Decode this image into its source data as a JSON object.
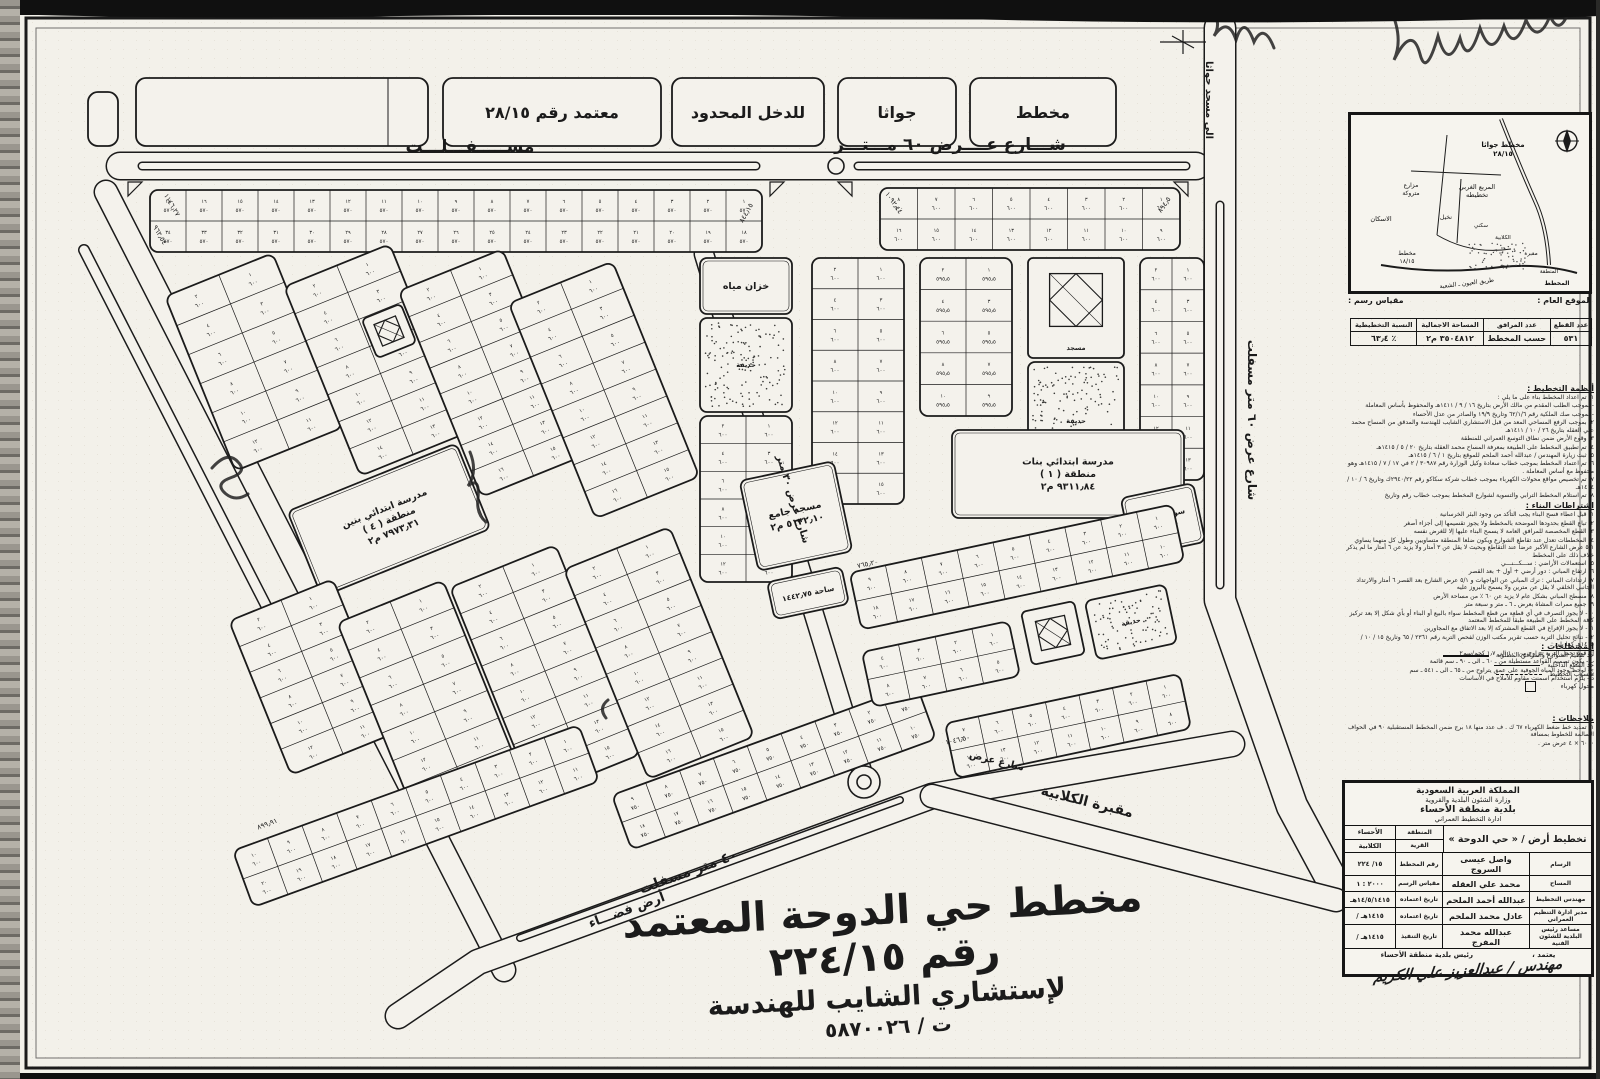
{
  "document": {
    "type": "مخطط تقسيم أراضٍ معتمد",
    "plan_number": "٢٢٤/١٥"
  },
  "calligraphy": {
    "line1": "مخطط حي الدوحة المعتمد رقم ٢٢٤/١٥",
    "line2": "لإستشاري الشايب للهندسة",
    "line3": "ت / ٥٨٧٠٠٢٦"
  },
  "map": {
    "paper": "#f4f2ec",
    "ink": "#1b1b1b",
    "roads": [
      {
        "d": "M 120 166 H 1196",
        "w": 26
      },
      {
        "d": "M 1220 28 L 1220 600 L 1292 806 L 1334 884",
        "w": 30
      },
      {
        "d": "M 106 192 L 504 970",
        "w": 22
      },
      {
        "d": "M 398 1016 L 478 962 L 932 796 L 1232 744",
        "w": 24
      },
      {
        "d": "M 704 254 L 864 778",
        "w": 18
      },
      {
        "d": "M 932 796 L 1336 900",
        "w": 22
      },
      {
        "d": "M 84 250 L 300 672",
        "w": 9
      }
    ],
    "medians": [
      {
        "d": "M 142 166 H 756",
        "w": 6
      },
      {
        "d": "M 858 166 H 1186",
        "w": 6
      },
      {
        "d": "M 1220 205 V 585",
        "w": 6
      },
      {
        "d": "M 520 938 L 900 800",
        "w": 5
      }
    ],
    "circles": [
      {
        "x": 836,
        "y": 166,
        "r": 8
      },
      {
        "x": 864,
        "y": 782,
        "r": 16
      },
      {
        "x": 864,
        "y": 782,
        "r": 7
      }
    ],
    "blocks": [
      {
        "type": "labelbox",
        "x": 88,
        "y": 92,
        "w": 30,
        "h": 54
      },
      {
        "type": "labelbox",
        "x": 136,
        "y": 78,
        "w": 292,
        "h": 68,
        "divider": 388
      },
      {
        "type": "labelbox",
        "x": 443,
        "y": 78,
        "w": 218,
        "h": 68,
        "label": "معتمد رقم ٢٨/١٥"
      },
      {
        "type": "labelbox",
        "x": 672,
        "y": 78,
        "w": 152,
        "h": 68,
        "label": "للدخل المحدود"
      },
      {
        "type": "labelbox",
        "x": 838,
        "y": 78,
        "w": 118,
        "h": 68,
        "label": "جواثا"
      },
      {
        "type": "labelbox",
        "x": 970,
        "y": 78,
        "w": 146,
        "h": 68,
        "label": "مخطط"
      },
      {
        "type": "parcels",
        "x": 150,
        "y": 190,
        "w": 612,
        "h": 62,
        "cols": 17,
        "rows": 2,
        "rot": 0,
        "area": "٥٧٠"
      },
      {
        "type": "parcels",
        "x": 880,
        "y": 188,
        "w": 300,
        "h": 62,
        "cols": 8,
        "rows": 2,
        "rot": 0,
        "area": "٦٠٠"
      },
      {
        "type": "parcels",
        "x": 196,
        "y": 268,
        "w": 116,
        "h": 188,
        "cols": 2,
        "rows": 6,
        "rot": -22,
        "area": "٦٠٠"
      },
      {
        "type": "parcels",
        "x": 318,
        "y": 258,
        "w": 114,
        "h": 204,
        "cols": 2,
        "rows": 7,
        "rot": -22,
        "area": "٦٠٠"
      },
      {
        "type": "parcels",
        "x": 436,
        "y": 262,
        "w": 112,
        "h": 222,
        "cols": 2,
        "rows": 8,
        "rot": -22,
        "area": "٦٠٠"
      },
      {
        "type": "parcels",
        "x": 548,
        "y": 274,
        "w": 112,
        "h": 232,
        "cols": 2,
        "rows": 8,
        "rot": -22,
        "area": "٦٠٠"
      },
      {
        "type": "mosque",
        "x": 368,
        "y": 310,
        "w": 42,
        "h": 42,
        "rot": -22,
        "small": true
      },
      {
        "type": "facility",
        "x": 298,
        "y": 474,
        "w": 182,
        "h": 92,
        "rot": -22,
        "lines": [
          "مدرسة ابتدائي بنين",
          "منطقة ( ٤ )",
          "٧٩٧٣٫٣١ م٢"
        ]
      },
      {
        "type": "parcels",
        "x": 256,
        "y": 594,
        "w": 112,
        "h": 166,
        "cols": 2,
        "rows": 6,
        "rot": -22,
        "area": "٦٠٠"
      },
      {
        "type": "parcels",
        "x": 372,
        "y": 594,
        "w": 114,
        "h": 208,
        "cols": 2,
        "rows": 7,
        "rot": -22,
        "area": "٦٠٠"
      },
      {
        "type": "parcels",
        "x": 488,
        "y": 558,
        "w": 114,
        "h": 226,
        "cols": 2,
        "rows": 8,
        "rot": -22,
        "area": "٦٠٠"
      },
      {
        "type": "parcels",
        "x": 602,
        "y": 540,
        "w": 114,
        "h": 226,
        "cols": 2,
        "rows": 8,
        "rot": -22,
        "area": "٦٠٠"
      },
      {
        "type": "parcels",
        "x": 232,
        "y": 786,
        "w": 368,
        "h": 60,
        "cols": 10,
        "rows": 2,
        "rot": -20,
        "area": "٦٠٠"
      },
      {
        "type": "parcels",
        "x": 612,
        "y": 738,
        "w": 324,
        "h": 58,
        "cols": 9,
        "rows": 2,
        "rot": -20,
        "area": "٧٥٠"
      },
      {
        "type": "facility",
        "x": 700,
        "y": 258,
        "w": 92,
        "h": 56,
        "rot": 0,
        "lines": [
          "خزان مياه"
        ]
      },
      {
        "type": "park",
        "x": 700,
        "y": 318,
        "w": 92,
        "h": 94,
        "label": "حديقة"
      },
      {
        "type": "parcels",
        "x": 700,
        "y": 416,
        "w": 92,
        "h": 166,
        "cols": 2,
        "rows": 6,
        "rot": 0,
        "area": "٦٠٠"
      },
      {
        "type": "parcels",
        "x": 812,
        "y": 258,
        "w": 92,
        "h": 246,
        "cols": 2,
        "rows": 8,
        "rot": 0,
        "area": "٦٠٠"
      },
      {
        "type": "parcels",
        "x": 920,
        "y": 258,
        "w": 92,
        "h": 158,
        "cols": 2,
        "rows": 5,
        "rot": 0,
        "area": "٥٩٥٫٥"
      },
      {
        "type": "mosque",
        "x": 1028,
        "y": 258,
        "w": 96,
        "h": 100,
        "rot": 0,
        "label": "مسجد"
      },
      {
        "type": "park",
        "x": 1028,
        "y": 362,
        "w": 96,
        "h": 118,
        "label": "حديقة"
      },
      {
        "type": "parcels",
        "x": 1140,
        "y": 258,
        "w": 64,
        "h": 222,
        "cols": 2,
        "rows": 7,
        "rot": 0,
        "area": "٦٠٠"
      },
      {
        "type": "facility",
        "x": 952,
        "y": 430,
        "w": 232,
        "h": 88,
        "rot": 0,
        "lines": [
          "مدرسة ابتدائي بنات",
          "منطقة ( ١ )",
          "٩٣١١٫٨٤ م٢"
        ]
      },
      {
        "type": "facility",
        "x": 748,
        "y": 470,
        "w": 96,
        "h": 92,
        "rot": -12,
        "lines": [
          "مسجد جامع",
          "٥١٣٢٫١٠ م٢"
        ]
      },
      {
        "type": "facility",
        "x": 770,
        "y": 574,
        "w": 76,
        "h": 38,
        "rot": -12,
        "lines": [
          "ساحة ١٤٤٢٫٧٥"
        ]
      },
      {
        "type": "facility",
        "x": 1126,
        "y": 490,
        "w": 74,
        "h": 60,
        "rot": -12,
        "lines": [
          "سوق مركزي",
          "٥١٦٢٫٥٠"
        ]
      },
      {
        "type": "parcels",
        "x": 852,
        "y": 538,
        "w": 330,
        "h": 58,
        "cols": 9,
        "rows": 2,
        "rot": -12,
        "area": "٦٠٠"
      },
      {
        "type": "parcels",
        "x": 866,
        "y": 636,
        "w": 150,
        "h": 56,
        "cols": 4,
        "rows": 2,
        "rot": -12,
        "area": "٦٠٠"
      },
      {
        "type": "mosque",
        "x": 1026,
        "y": 606,
        "w": 54,
        "h": 54,
        "rot": -12,
        "small": true
      },
      {
        "type": "park",
        "x": 1090,
        "y": 592,
        "w": 82,
        "h": 60,
        "rot": -12,
        "label": "حديقة"
      },
      {
        "type": "parcels",
        "x": 948,
        "y": 698,
        "w": 240,
        "h": 56,
        "cols": 7,
        "rows": 2,
        "rot": -12,
        "area": "٦٠٠"
      }
    ],
    "street_labels": [
      {
        "t": "مســـــفـــلـــت",
        "x": 470,
        "y": 152,
        "s": 17,
        "r": 0
      },
      {
        "t": "شـــارع عــــرض  ٦٠  مـــتـــر",
        "x": 950,
        "y": 150,
        "s": 17,
        "r": 0
      },
      {
        "t": "شارع عرض ٦٠ متر مسفلت",
        "x": 1248,
        "y": 420,
        "s": 12,
        "r": 90
      },
      {
        "t": "الى مسجد جواثا",
        "x": 1206,
        "y": 100,
        "s": 10,
        "r": 90
      },
      {
        "t": "شارع عرض ٣٠ متر",
        "x": 790,
        "y": 500,
        "s": 10,
        "r": 73
      },
      {
        "t": "٤٠ متر مسفلت",
        "x": 690,
        "y": 876,
        "s": 14,
        "r": -20
      },
      {
        "t": "أرض فضـــاء",
        "x": 628,
        "y": 914,
        "s": 13,
        "r": -20
      },
      {
        "t": "مقبرة الكلابية",
        "x": 1086,
        "y": 806,
        "s": 14,
        "r": 14
      },
      {
        "t": "شارع عرض",
        "x": 996,
        "y": 764,
        "s": 10,
        "r": 14
      }
    ],
    "corner_labels": [
      {
        "t": "١١٤٦٫٢٧",
        "x": 170,
        "y": 206,
        "s": 7,
        "r": 60
      },
      {
        "t": "٩٦٢٫٥٤",
        "x": 158,
        "y": 236,
        "s": 7,
        "r": 60
      },
      {
        "t": "٨٤٤٫١٥",
        "x": 748,
        "y": 214,
        "s": 7,
        "r": -60
      },
      {
        "t": "١٠٩٢٫٤٤",
        "x": 892,
        "y": 204,
        "s": 7,
        "r": 55
      },
      {
        "t": "٨٩٤٫٥",
        "x": 1166,
        "y": 206,
        "s": 7,
        "r": -55
      },
      {
        "t": "٨٩٩٫٩١",
        "x": 268,
        "y": 826,
        "s": 7,
        "r": -20
      },
      {
        "t": "١٠٤٦٫٥٠",
        "x": 958,
        "y": 742,
        "s": 7,
        "r": -12
      },
      {
        "t": "٧٦٥٫٢٠",
        "x": 868,
        "y": 566,
        "s": 7,
        "r": -12
      }
    ]
  },
  "locmap": {
    "caption_right": "الموقع العام :",
    "caption_left": "مقياس رسم :",
    "labels": [
      {
        "t": "مخطط جواثا",
        "x": 152,
        "y": 32,
        "s": 7,
        "b": 1
      },
      {
        "t": "٢٨/١٥",
        "x": 152,
        "y": 41,
        "s": 7,
        "b": 1
      },
      {
        "t": "المربع الغربي",
        "x": 126,
        "y": 74,
        "s": 6.5
      },
      {
        "t": "تخطيطه",
        "x": 126,
        "y": 82,
        "s": 6.5
      },
      {
        "t": "مزارع",
        "x": 60,
        "y": 72,
        "s": 6
      },
      {
        "t": "متروكة",
        "x": 60,
        "y": 80,
        "s": 6
      },
      {
        "t": "نخيل",
        "x": 95,
        "y": 104,
        "s": 6
      },
      {
        "t": "الاسكان",
        "x": 30,
        "y": 106,
        "s": 6.5
      },
      {
        "t": "مخطط",
        "x": 56,
        "y": 140,
        "s": 6
      },
      {
        "t": "١٨/١٥",
        "x": 56,
        "y": 148,
        "s": 6
      },
      {
        "t": "سكني",
        "x": 130,
        "y": 112,
        "s": 5.5
      },
      {
        "t": "الكلابية",
        "x": 152,
        "y": 124,
        "s": 5.5
      },
      {
        "t": "مقبرة",
        "x": 180,
        "y": 140,
        "s": 5.5
      },
      {
        "t": "المنطقة",
        "x": 198,
        "y": 158,
        "s": 5.5
      },
      {
        "t": "طريق العيون ـ الشعبة",
        "x": 116,
        "y": 170,
        "s": 6,
        "r": -7
      },
      {
        "t": "المخطط",
        "x": 206,
        "y": 170,
        "s": 6,
        "b": 1
      }
    ]
  },
  "stats": {
    "headers": [
      "عدد القطع",
      "عدد المرافق",
      "المساحة الاجمالية",
      "النسبة التخطيطية"
    ],
    "values": [
      "٥٣١",
      "حسب المخطط",
      "٣٥٠٤٨١٢ م٢",
      "٪ ٦٣٫٤"
    ]
  },
  "notes": {
    "section1_title": "أنظمة التخطيط :",
    "section1": [
      "١- تم اعداد المخطط بناء على ما يلي :",
      "- بموجب الطلب المقدم من مالك الأرض بتاريخ ١٦ / ٩ / ١٤١١هـ والمحفوظ بأساس المعاملة",
      "- بموجب صك الملكية رقم ٦٢/١/٦ وتاريخ ١٩/٩ والصادر من عدل الأحساء",
      "٢- بموجب الرفع المساحي المعد من قبل الاستشاري الشايب للهندسة والمدقق من المساح محمد علي العقله بتاريخ ٢٦ / ١٠ / ١٤١١هـ",
      "٣- وقوع الأرض ضمن نطاق التوسع العمراني للمنطقة",
      "٤- تم تطبيق المخطط على الطبيعة بمعرفة المساح محمد العقله بتاريخ ٢٠ / ٥ / ١٤١٥هـ",
      "٥- ثبت زيارة المهندس / عبدالله أحمد الملحم للموقع بتاريخ ١ / ٦ / ١٤١٥هـ",
      "٦- تم اعتماد المخطط بموجب خطاب سعادة وكيل الوزارة رقم ٣٠٩٨٧ / ٢ في ١٧ / ٧ / ١٤١٥هـ وهو محفوظ مع أساس المعاملة .",
      "٧- تم تخصيص مواقع محولات الكهرباء بموجب خطاب شركة سكاكو رقم ٢٩٤٠/٢٢ك وتاريخ ٦ / ١٠ / ١٤١٤هـ",
      "٨- تم استلام المخطط الترابي والتسوية لشوارع المخطط بموجب خطاب رقم وتاريخ"
    ],
    "section2_title": "اشتراطات البناء :",
    "section2": [
      "١- قبل اعطاء فسح البناء يجب التأكد من وجود البئر الخرسانية",
      "٢- تباع القطع بحدودها الموضحة بالمخطط ولا يجوز تقسيمها إلى أجزاء أصغر",
      "٣- القطع المخصصة للمرافق العامة لا يسمح البناء عليها إلا للغرض نفسه",
      "٤- المخططات تعدل عند تقاطع الشوارع ويكون ضلعا المنطقة متساويين وطول كل منهما يساوي ٥/١ عرض الشارع الأكبر عرضاً عند التقاطع وبحيث لا يقل عن ٣ أمتار ولا يزيد عن ٦ أمتار ما لم يذكر خلاف ذلك على المخطط",
      "٥- استعمالات الأراضي : ســـكـــنـــي",
      "٦- ارتفاع المباني : دور أرضي + أول + بعد القصر",
      "٧- ارتدادات المباني : ترك المباني عن الواجهات و ٥/١ عرض الشارع بعد القصر ٦ أمتار والارتداد الجانبي الخلفي لا يقل عن مترين ولا يسمح بالبروز عليه",
      "٨- مسطح المباني بشكل عام لا يزيد عن ٦٠ ٪ من مساحة الأرض",
      "٩- جميع ممرات المشاة بعرض ـ ٦ ـ متر و سبعة متر",
      "١٠- لا يجوز التصرف في أي قطعة من قطع المخطط سواء بالبيع أو البناء أو بأي شكل إلا بعد تركيز كافة المخطط على الطبيعة طبقاً للمخطط المعتمد",
      "١١- لا يجوز الإفراغ في القطع المشتركة إلا بعد الاتفاق مع المجاورين",
      "١٢- نتائج تحليل التربة حسب تقرير مكتب الوزن لفحص التربة رقم ٢٣٦١ / ٦٥ وتاريخ ١٥ / ١٠ / ١٤١٥هـ كما يلي :",
      "أ - قوة تحمل التربة تتراوح من ١٫٠ الى ١٫٧ كجم/سم٢",
      "ب- يكون تصميم القواعد مستطيلة من ـ ٦٠ ـ الى ـ ٩٠ ـ سم قائمة",
      "ج- لوحظ وجود المياه الجوفية على عمق يتراوح من ـ ٦٥ ـ الى ـ ٥٤١ ـ سم",
      "د - يلزم استخدام اسمنت مقاوم للأملاح في الأساسات"
    ]
  },
  "legend": {
    "title": "المصطلحات :",
    "rows": [
      {
        "label": "حد تنظيم الشوارع والمرافق المطلوبة",
        "sample": "solid"
      },
      {
        "label": "حد القطع الداخلية",
        "sample": "thin"
      },
      {
        "label": "منسوب التخطيط",
        "sample": "dash"
      },
      {
        "label": "محول كهرباء",
        "sample": "square"
      }
    ]
  },
  "remarks": {
    "title": "ملاحظات :",
    "lines": [
      "١- تمديد خط ضغط الكهرباء ٦٧ ك . ف عدد منها ١٨ برج ضمن المخطط المستقبلية ٩٠ في الحواف السالمة للخطوط بمسافة",
      "٦٠٠٠ × ٤ عرض متر ."
    ]
  },
  "approval": {
    "header1": "المملكة العربية السعودية",
    "header2": "وزارة الشئون البلدية والقروية",
    "header3": "بلدية منطقة الأحساء",
    "header4": "ادارة التخطيط العمراني",
    "title": "تخطيط أرض / « حي الدوحة »",
    "region_label": "المنطقة",
    "region": "الأحساء",
    "village_label": "القرية",
    "village": "الكلابية",
    "rows": [
      {
        "role": "الرسام",
        "name": "واصل عيسى السروج",
        "klabel": "رقم المخطط",
        "value": "١٥/ ٢٢٤"
      },
      {
        "role": "المساح",
        "name": "محمد علي العقله",
        "klabel": "مقياس الرسم",
        "value": "٢٠٠٠ : ١"
      },
      {
        "role": "مهندس التخطيط",
        "name": "عبدالله أحمد الملحم",
        "klabel": "تاريخ اعتماده",
        "value": "١٤/٥/١٤١٥هـ"
      },
      {
        "role": "مدير ادارة التنظيم العمراني",
        "name": "عادل محمد الملحم",
        "klabel": "تاريخ اعتماده",
        "value": "١٤١٥هـ /"
      },
      {
        "role": "مساعد رئيس البلدية للشئون الفنية",
        "name": "عبدالله محمد المفرج",
        "klabel": "تاريخ التنفيذ",
        "value": "١٤١٥هـ /"
      }
    ],
    "approve_label": "يعتمد ،",
    "approve_by": "رئيس بلدية منطقة الأحساء",
    "signature": "مهندس / عبدالعزيز علي الكريم"
  }
}
